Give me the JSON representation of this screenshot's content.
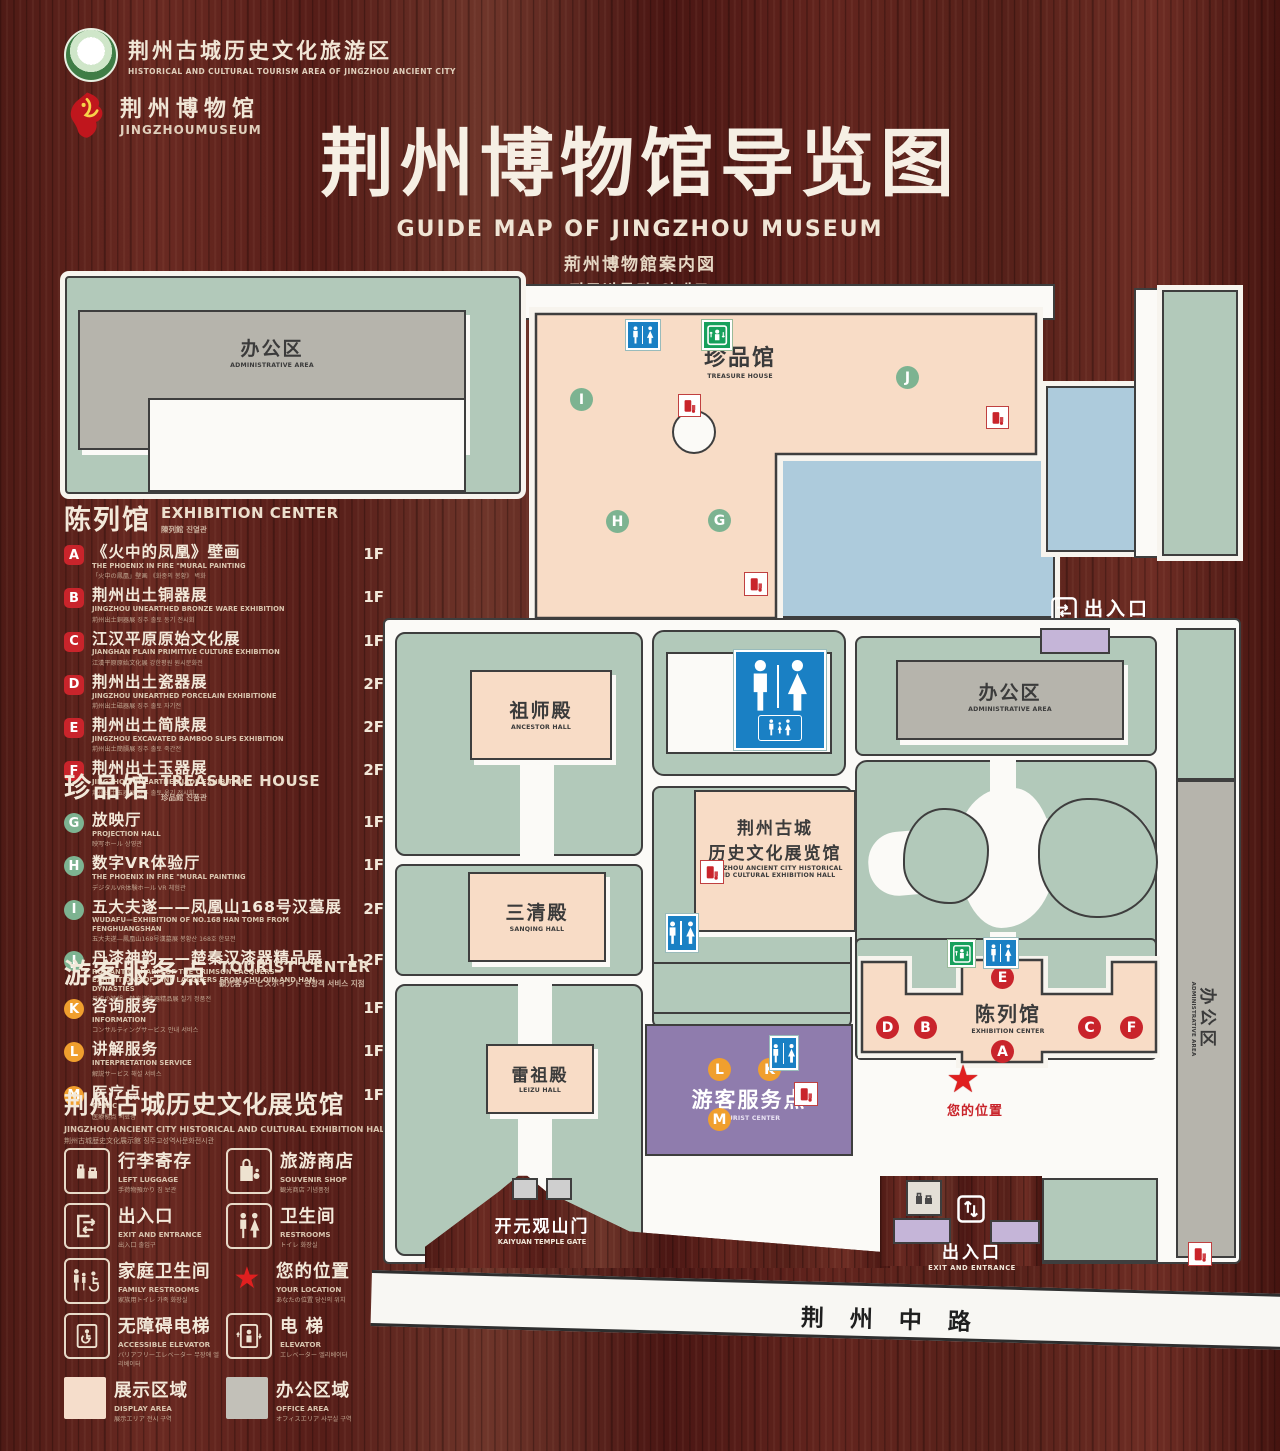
{
  "header": {
    "logo1_zh": "荆州古城历史文化旅游区",
    "logo1_en": "HISTORICAL AND CULTURAL TOURISM AREA OF JINGZHOU ANCIENT CITY",
    "logo2_zh": "荆州博物馆",
    "logo2_en": "JINGZHOUMUSEUM",
    "title_zh": "荆州博物馆导览图",
    "title_en": "GUIDE MAP OF JINGZHOU MUSEUM",
    "title_ja": "荊州博物館案内図",
    "title_ko": "징주박물관 안내도"
  },
  "sidebar": {
    "sections": [
      {
        "zh": "陈列馆",
        "en": "EXHIBITION CENTER",
        "sub": "陳列館  진열관",
        "items": [
          {
            "letter": "A",
            "zh": "《火中的凤凰》壁画",
            "en": "THE PHOENIX IN FIRE \"MURAL PAINTING",
            "sub": "「火中の鳳凰」壁画 《화중의 봉황》 벽화",
            "floor": "1F"
          },
          {
            "letter": "B",
            "zh": "荆州出土铜器展",
            "en": "JINGZHOU UNEARTHED BRONZE WARE EXHIBITION",
            "sub": "荊州出土銅器展  징주 출토 동기 전시회",
            "floor": "1F"
          },
          {
            "letter": "C",
            "zh": "江汉平原原始文化展",
            "en": "JIANGHAN PLAIN PRIMITIVE CULTURE EXHIBITION",
            "sub": "江漢平原原始文化展  강한평원 원시문화전",
            "floor": "1F"
          },
          {
            "letter": "D",
            "zh": "荆州出土瓷器展",
            "en": "JINGZHOU UNEARTHED PORCELAIN EXHIBITIONE",
            "sub": "荊州出土磁器展  징주 출토 자기전",
            "floor": "2F"
          },
          {
            "letter": "E",
            "zh": "荆州出土简牍展",
            "en": "JINGZHOU EXCAVATED BAMBOO SLIPS EXHIBITION",
            "sub": "荊州出土簡牘展  징주 출토 죽간전",
            "floor": "2F"
          },
          {
            "letter": "F",
            "zh": "荆州出土玉器展",
            "en": "JINGZHOU UNEARTHED JADE EXHIBITION",
            "sub": "荊州出土玉器展  징주 출토 옥기 전시회",
            "floor": "2F"
          }
        ]
      },
      {
        "zh": "珍品馆",
        "en": "TREASURE HOUSE",
        "sub": "珍品館  진품관",
        "items": [
          {
            "letter": "G",
            "zh": "放映厅",
            "en": "PROJECTION HALL",
            "sub": "映写ホール  상영관",
            "floor": "1F"
          },
          {
            "letter": "H",
            "zh": "数字VR体验厅",
            "en": "THE PHOENIX IN FIRE \"MURAL PAINTING",
            "sub": "デジタルVR体験ホール  VR 체험관",
            "floor": "1F"
          },
          {
            "letter": "I",
            "zh": "五大夫遂——凤凰山168号汉墓展",
            "en": "WUDAFU—EXHIBITION OF NO.168 HAN TOMB FROM FENGHUANGSHAN",
            "sub": "五大夫遂—鳳凰山168号漢墓展  봉황산 168호 한묘전",
            "floor": "2F"
          },
          {
            "letter": "J",
            "zh": "丹漆神韵——楚秦汉漆器精品展",
            "en": "ROMANTIC CHARM OF THE CRIMSON LACQUERS— EXHIBITIONS OF FINE LACQUERS FROM CHU,QIN AND HAN DYNASTIES",
            "sub": "丹漆の神韻—楚秦漢漆器精品展  칠기 정품전",
            "floor": "1-2F"
          }
        ]
      },
      {
        "zh": "游客服务点",
        "en": "TOURIST CENTER",
        "sub": "観光客サービスポイント  관광객 서비스 지점",
        "items": [
          {
            "letter": "K",
            "zh": "咨询服务",
            "en": "INFORMATION",
            "sub": "コンサルティングサービス  안내 서비스",
            "floor": "1F"
          },
          {
            "letter": "L",
            "zh": "讲解服务",
            "en": "INTERPRETATION SERVICE",
            "sub": "解説サービス  해설 서비스",
            "floor": "1F"
          },
          {
            "letter": "M",
            "zh": "医疗点",
            "en": "CLINIC",
            "sub": "医療拠点  의료점",
            "floor": "1F"
          }
        ]
      }
    ],
    "hall": {
      "zh": "荆州古城历史文化展览馆",
      "en": "JINGZHOU ANCIENT CITY HISTORICAL AND CULTURAL EXHIBITION HALL",
      "sub": "荆州古城歴史文化展示館    징주고성역사문화전시관"
    }
  },
  "legend": {
    "items": [
      {
        "zh": "行李寄存",
        "en": "LEFT LUGGAGE",
        "sub": "手荷物預かり  짐 보관"
      },
      {
        "zh": "旅游商店",
        "en": "SOUVENIR SHOP",
        "sub": "観光商店  기념품점"
      },
      {
        "zh": "出入口",
        "en": "EXIT AND ENTRANCE",
        "sub": "出入口  출입구"
      },
      {
        "zh": "卫生间",
        "en": "RESTROOMS",
        "sub": "トイレ  화장실"
      },
      {
        "zh": "家庭卫生间",
        "en": "FAMILY RESTROOMS",
        "sub": "家族用トイレ  가족 화장실"
      },
      {
        "zh": "您的位置",
        "en": "YOUR LOCATION",
        "sub": "あなたの位置  당신의 위치"
      },
      {
        "zh": "无障碍电梯",
        "en": "ACCESSIBLE ELEVATOR",
        "sub": "バリアフリーエレベーター  무장애 엘리베이터"
      },
      {
        "zh": "电  梯",
        "en": "ELEVATOR",
        "sub": "エレベーター  엘리베이터"
      },
      {
        "zh": "展示区域",
        "en": "DISPLAY AREA",
        "sub": "展示エリア  전시 구역"
      },
      {
        "zh": "办公区域",
        "en": "OFFICE AREA",
        "sub": "オフィスエリア  사무실 구역"
      }
    ]
  },
  "map": {
    "treasure_zh": "珍品馆",
    "treasure_en": "TREASURE HOUSE",
    "admin_zh": "办公区",
    "admin_en": "ADMINISTRATIVE AREA",
    "ancestor_zh": "祖师殿",
    "ancestor_en": "ANCESTOR HALL",
    "sanqing_zh": "三清殿",
    "sanqing_en": "SANQING HALL",
    "leizu_zh": "雷祖殿",
    "leizu_en": "LEIZU HALL",
    "hall_zh1": "荆州古城",
    "hall_zh2": "历史文化展览馆",
    "hall_en1": "JINGZHOU ANCIENT CITY HISTORICAL",
    "hall_en2": "AND CULTURAL EXHIBITION HALL",
    "exhibition_zh": "陈列馆",
    "exhibition_en": "EXHIBITION CENTER",
    "tourist_zh": "游客服务点",
    "tourist_en": "TOURIST CENTER",
    "gate_zh": "开元观山门",
    "gate_en": "KAIYUAN TEMPLE GATE",
    "exit_zh": "出入口",
    "exit_en": "EXIT AND ENTRANCE",
    "location_zh": "您的位置",
    "road_zh": "荆州中路",
    "star": "★",
    "markers": {
      "A": "A",
      "B": "B",
      "C": "C",
      "D": "D",
      "E": "E",
      "F": "F",
      "G": "G",
      "H": "H",
      "I": "I",
      "J": "J",
      "K": "K",
      "L": "L",
      "M": "M"
    }
  },
  "colors": {
    "accent_red": "#c9242b",
    "marker_green": "#7db391",
    "marker_orange": "#f09f2e",
    "display_area_pink": "#f8dcc6",
    "office_gray": "#b6b4ac",
    "ground_sage": "#b2c9ba",
    "pond_blue": "#adcbdc",
    "tourist_purple": "#8f7cad",
    "gate_lavender": "#c5b5d8",
    "restroom_blue": "#1a80c4",
    "elevator_green": "#17a05c"
  }
}
